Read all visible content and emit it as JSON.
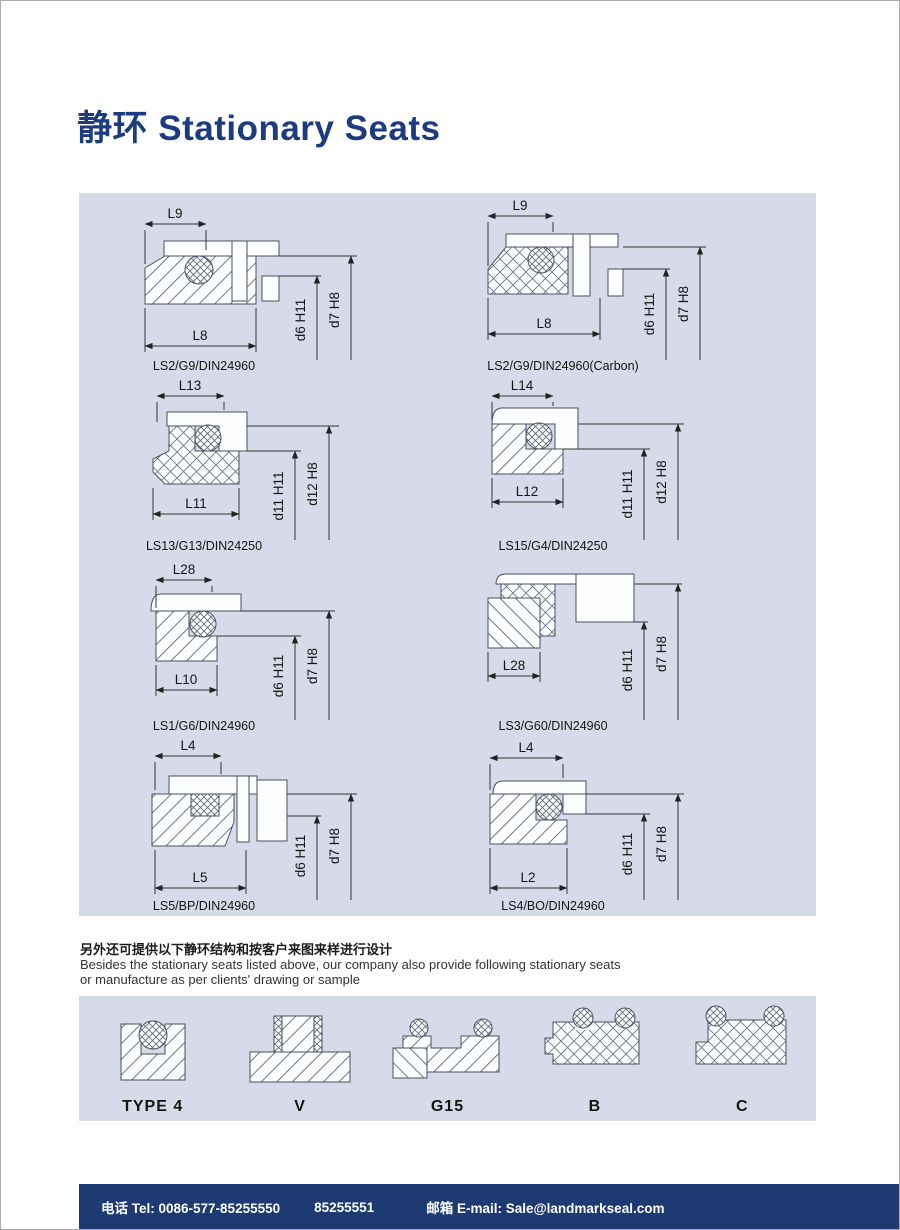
{
  "page": {
    "title": "静环 Stationary Seats"
  },
  "note": {
    "cn": "另外还可提供以下静环结构和按客户来图来样进行设计",
    "en1": "Besides the stationary seats listed above, our company also provide following stationary seats",
    "en2": "or manufacture as per clients' drawing or sample"
  },
  "diagrams": [
    {
      "caption": "LS2/G9/DIN24960",
      "dim_top": "L9",
      "dim_bottom": "L8",
      "dim_inner": "d6 H11",
      "dim_outer": "d7 H8"
    },
    {
      "caption": "LS2/G9/DIN24960(Carbon)",
      "dim_top": "L9",
      "dim_bottom": "L8",
      "dim_inner": "d6 H11",
      "dim_outer": "d7 H8"
    },
    {
      "caption": "LS13/G13/DIN24250",
      "dim_top": "L13",
      "dim_bottom": "L11",
      "dim_inner": "d11 H11",
      "dim_outer": "d12 H8"
    },
    {
      "caption": "LS15/G4/DIN24250",
      "dim_top": "L14",
      "dim_bottom": "L12",
      "dim_inner": "d11 H11",
      "dim_outer": "d12 H8"
    },
    {
      "caption": "LS1/G6/DIN24960",
      "dim_top": "L28",
      "dim_bottom": "L10",
      "dim_inner": "d6 H11",
      "dim_outer": "d7 H8"
    },
    {
      "caption": "LS3/G60/DIN24960",
      "dim_bottom": "L28",
      "dim_inner": "d6 H11",
      "dim_outer": "d7 H8"
    },
    {
      "caption": "LS5/BP/DIN24960",
      "dim_top": "L4",
      "dim_bottom": "L5",
      "dim_inner": "d6 H11",
      "dim_outer": "d7 H8"
    },
    {
      "caption": "LS4/BO/DIN24960",
      "dim_top": "L4",
      "dim_bottom": "L2",
      "dim_inner": "d6 H11",
      "dim_outer": "d7 H8"
    }
  ],
  "profiles": [
    {
      "label": "TYPE 4"
    },
    {
      "label": "V"
    },
    {
      "label": "G15"
    },
    {
      "label": "B"
    },
    {
      "label": "C"
    }
  ],
  "footer": {
    "phone": "电话 Tel: 0086-577-85255550",
    "phone2": "85255551",
    "email": "邮箱 E-mail: Sale@landmarkseal.com"
  },
  "colors": {
    "accent": "#1c3b80",
    "panel": "#d7dbe9",
    "footer_bg": "#1d3a72"
  }
}
